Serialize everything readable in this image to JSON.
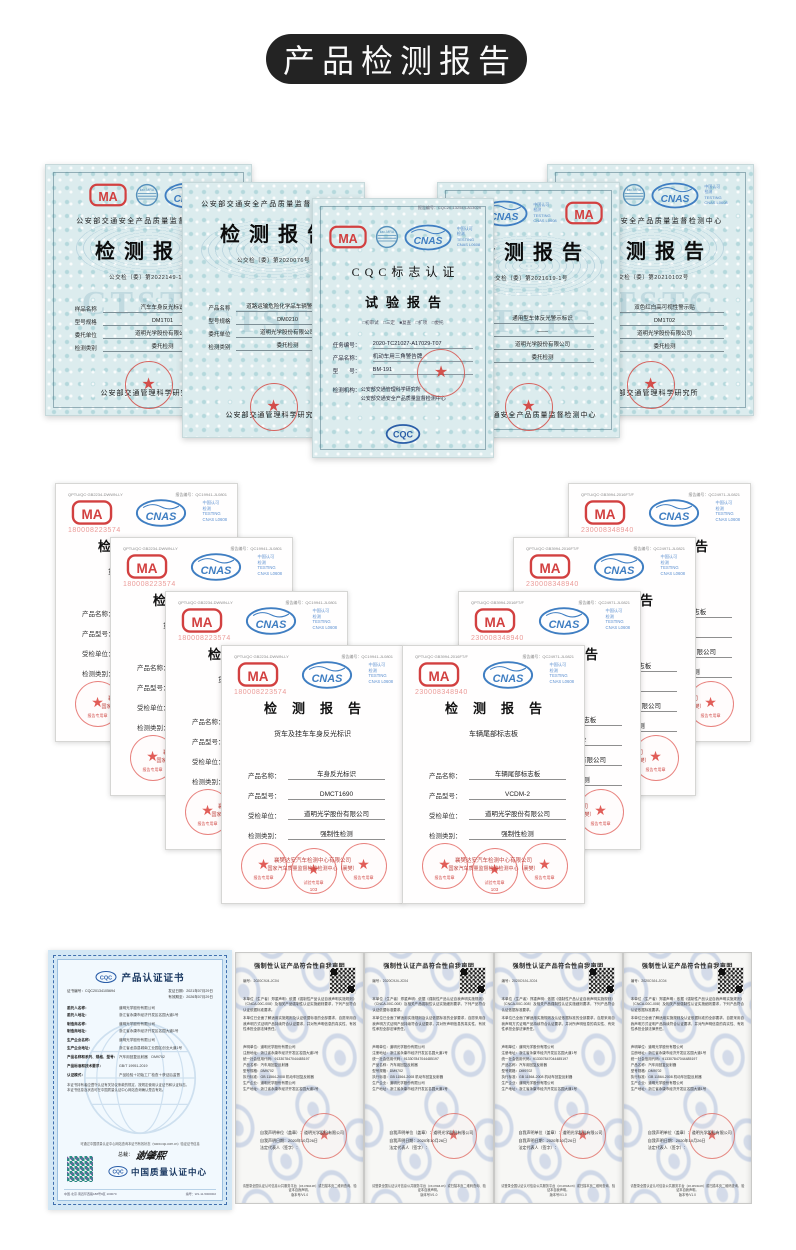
{
  "header": {
    "title": "产品检测报告"
  },
  "shared": {
    "cma_text": "MA",
    "cnas_text": "CNAS",
    "ilac_text": "ilac-MRA",
    "cqc_text": "CQC",
    "star": "★",
    "cnas_side": [
      "中国认可",
      "检测",
      "TESTING",
      "CNAS L0608"
    ]
  },
  "top_row": {
    "agency": "公安部交通安全产品质量监督检测中心",
    "cert_a": {
      "title": "检测报告",
      "doc_no": "公交检〔委〕第2022149-1号",
      "watermark": "CTSTC",
      "fields": [
        {
          "label": "样品名称",
          "value": "汽车车身反光标识"
        },
        {
          "label": "型号规格",
          "value": "DM1T01"
        },
        {
          "label": "委托单位",
          "value": "道明光学股份有限公司"
        },
        {
          "label": "检测类别",
          "value": "委托检测"
        }
      ],
      "footer": "公安部交通管理科学研究所"
    },
    "cert_b": {
      "title": "检测报告",
      "doc_no": "公交检〔委〕第2020076号",
      "watermark": "CTSTC",
      "fields": [
        {
          "label": "产品名称",
          "value": "道路运输危险化学品车辆警示标牌"
        },
        {
          "label": "型号规格",
          "value": "DM0210"
        },
        {
          "label": "委托单位",
          "value": "道明光学股份有限公司"
        },
        {
          "label": "检测类别",
          "value": "委托检测"
        }
      ],
      "footer": "公安部交通管理科学研究所"
    },
    "cert_cqc": {
      "report_no": "报告编号：CQC20-132544-A13029",
      "title1": "CQC标志认证",
      "title2": "试验报告",
      "checks": "□初审试　□三定　■复查　□扩项　□委托",
      "fields": [
        {
          "label": "任务编号：",
          "value": "2020-TC21027-A17029-T07"
        },
        {
          "label": "产品名称：",
          "value": "机动车用三角警告牌"
        },
        {
          "label": "型　　号：",
          "value": "BM-191"
        }
      ],
      "agency_label": "检测机构：",
      "agency_line1": "公安部交通管理科学研究所",
      "agency_line2": "公安部交通安全产品质量监督检测中心"
    },
    "cert_d": {
      "title": "检测报告",
      "doc_no": "公交检〔委〕第2021619-1号",
      "watermark": "CTSTC",
      "fields": [
        {
          "label": "产品名称",
          "value": "通用型车体反光警示标识"
        },
        {
          "label": "型号规格",
          "value": "——"
        },
        {
          "label": "委托单位",
          "value": "道明光学股份有限公司"
        },
        {
          "label": "检测类别",
          "value": "委托检测"
        }
      ],
      "footer": "公安部交通安全产品质量监督检测中心"
    },
    "cert_e": {
      "title": "检测报告",
      "doc_no": "公交检〔委〕第20210102号",
      "watermark": "CTSTC",
      "fields": [
        {
          "label": "样品名称",
          "value": "双色红白高可视性警示贴"
        },
        {
          "label": "型号规格",
          "value": "DM1T02"
        },
        {
          "label": "委托单位",
          "value": "道明光学股份有限公司"
        },
        {
          "label": "检测类别",
          "value": "委托检测"
        }
      ],
      "footer": "公安部交通管理科学研究所"
    }
  },
  "middle": {
    "left": {
      "code": "QPTU/QC·GB2234-DWWN-LY",
      "report_no": "报告编号：QC19941-JL0801",
      "cma_no": "180008223574",
      "title": "检测报告",
      "subtitle": "货车及挂车车身反光标识",
      "fields": [
        {
          "label": "产品名称：",
          "value": "车身反光标识"
        },
        {
          "label": "产品型号：",
          "value": "DMCT1690"
        },
        {
          "label": "受检单位：",
          "value": "道明光学股份有限公司"
        },
        {
          "label": "检测类别：",
          "value": "强制性检测"
        }
      ]
    },
    "right": {
      "code": "QPTU/QC·GB3994-2016FT/F",
      "report_no": "报告编号：QC24971-JL0821",
      "cma_no": "230008348940",
      "title": "检测报告",
      "subtitle": "车辆尾部标志板",
      "fields": [
        {
          "label": "产品名称：",
          "value": "车辆尾部标志板"
        },
        {
          "label": "产品型号：",
          "value": "VCDM-2"
        },
        {
          "label": "受检单位：",
          "value": "道明光学股份有限公司"
        },
        {
          "label": "检测类别：",
          "value": "强制性检测"
        }
      ]
    },
    "stamp": {
      "line1": "襄樊达安汽车检测中心有限公司",
      "line2": "国家汽车质量监督检验检测中心（襄樊）",
      "seal_left": "报告专用章",
      "seal_center": "试验专用章",
      "seal_num": "103",
      "seal_right": "报告专用章"
    }
  },
  "bottom": {
    "cqc_cert": {
      "title": "产品认证证书",
      "cert_no": "证书编号：CQC20134105694",
      "issue_date": "发证日期：2021年07月29日",
      "valid_date": "有效期至：2026年07月29日",
      "rows": [
        {
          "label": "委托人名称：",
          "value": "道明光学股份有限公司"
        },
        {
          "label": "委托人地址：",
          "value": "浙江省永康市经济开发区名园大道1号"
        },
        {
          "label": "制造商名称：",
          "value": "道明光学股份有限公司"
        },
        {
          "label": "制造商地址：",
          "value": "浙江省永康市经济开发区名园大道1号"
        },
        {
          "label": "生产企业名称：",
          "value": "道明光学股份有限公司"
        },
        {
          "label": "生产企业地址：",
          "value": "浙江省龙游县城南工业园区创业大道1号"
        },
        {
          "label": "产品名称和系列、规格、型号：",
          "value": "汽车用回复反射器　DM9702"
        },
        {
          "label": "产品标准和技术要求：",
          "value": "GB/T 19951-2019"
        },
        {
          "label": "认证模式：",
          "value": "产品检验＋初始工厂检查＋获证后监督"
        }
      ],
      "note1": "本证书持有者应遵守认证有关协议条款的规定，按规定使用认证证书和认证标志。",
      "note2": "本证书信息及状态可在中国质量认证中心网站查询确认是否有效。",
      "query_line": "可通过中国质量认证中心网站查询本证书有效状态（www.cqc.com.cn）验证证书信息",
      "president_label": "总裁：",
      "signature": "谢肇熙",
      "org_name": "中国质量认证中心",
      "footer_addr": "中国·北京·南四环西路188号9区 100070",
      "footer_no": "编号：W1-11-5000002"
    },
    "declaration": {
      "title": "强制性认证产品符合性自我声明",
      "doc_no": "编号：2020C9J4-JC04",
      "para1": "本单位（生产者）郑重声明：依据《强制性产品认证自我声明实施规则》（CNCA-00C-008）及相关产品强制性认证实施细则要求，下列产品符合认证依据标准要求。",
      "para2": "本单位已全面了解适用实施规则及认证依据标准的全部要求，自愿采用自我声明方式证明产品持续符合认证要求，并对所声明信息的真实性、有效性承担全部法律责任。",
      "info": [
        "声明单位：道明光学股份有限公司",
        "注册地址：浙江省永康市经济开发区名园大道1号",
        "统一社会信用代码：913307847044485197",
        "产品名称：汽车用回复反射器",
        "型号规格：DM9702",
        "执行标准：GB 11564-2008 机动车回复反射器",
        "生产企业：道明光学股份有限公司",
        "生产地址：浙江省永康市经济开发区名园大道1号"
      ],
      "sign1": "自我声明单位（盖章）：道明光学股份有限公司",
      "sign2": "自我声明日期：2020年10月26日",
      "sign3": "法定代表人（签字）：",
      "footer1": "请登录全国认证认可信息公共服务平台（cx.cnca.cn）或扫描本页二维码查询、验证本自我声明。",
      "footer2": "版本号/V1.0"
    }
  }
}
